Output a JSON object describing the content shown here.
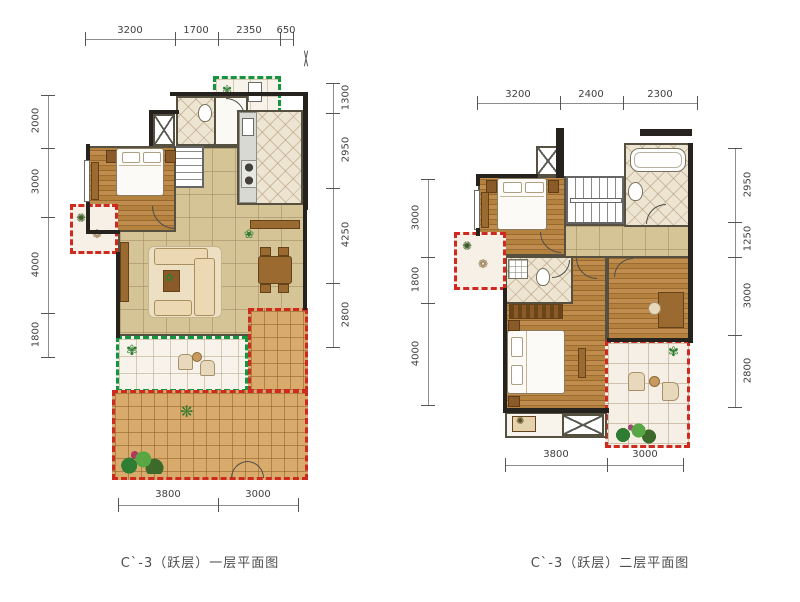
{
  "figure": {
    "type": "residential floor plan pair",
    "background": "#ffffff"
  },
  "plans": [
    {
      "title": "C`-3（跃层）一层平面图",
      "dims_top": [
        "3200",
        "1700",
        "2350",
        "650"
      ],
      "dims_left": [
        "2000",
        "3000",
        "4000",
        "1800"
      ],
      "dims_right": [
        "1300",
        "2950",
        "4250",
        "2800"
      ],
      "dims_bottom": [
        "3800",
        "3000"
      ]
    },
    {
      "title": "C`-3（跃层）二层平面图",
      "dims_top": [
        "3200",
        "2400",
        "2300"
      ],
      "dims_left": [
        "3000",
        "1800",
        "4000"
      ],
      "dims_right": [
        "2950",
        "1250",
        "3000",
        "2800"
      ],
      "dims_bottom": [
        "3800",
        "3000"
      ]
    }
  ],
  "colors": {
    "wall": "#26231e",
    "wood_floor": "#b5813f",
    "living_tile": "#d5c496",
    "deck_tile": "#d8ab6c",
    "bath_tile": "#eee4d2",
    "balcony_red_dash": "#cf2a1f",
    "balcony_green_dash": "#149540",
    "dimension_text": "#3f3f3f"
  }
}
